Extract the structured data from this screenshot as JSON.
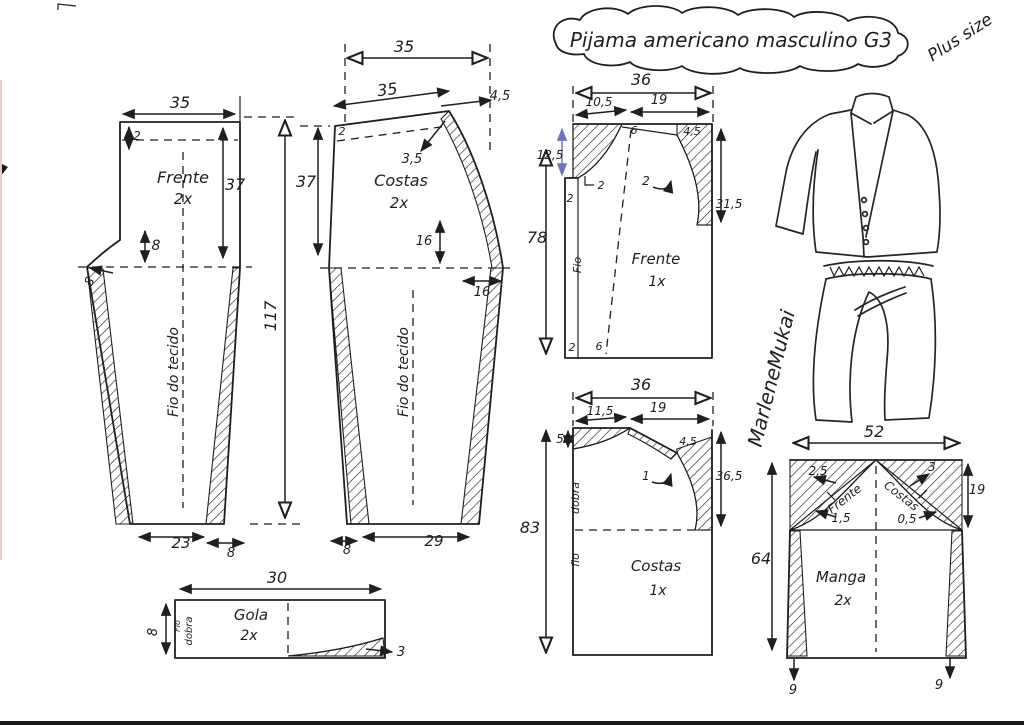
{
  "title": "Pijama americano masculino G3",
  "size_tag": "Plus size",
  "signature": "MarleneMukai",
  "colors": {
    "ink": "#1f1f1f",
    "blue": "#6f74b8",
    "lightblue": "#959bc2",
    "paper": "#ffffff"
  },
  "pieces": [
    {
      "name": "pants-front",
      "label": "Frente",
      "quantity": "2x",
      "grain_label": "Fio do tecido",
      "measurements": [
        "35",
        "2",
        "37",
        "8",
        "8",
        "117",
        "23",
        "8"
      ]
    },
    {
      "name": "pants-back",
      "label": "Costas",
      "quantity": "2x",
      "grain_label": "Fio do tecido",
      "measurements": [
        "35",
        "35",
        "4,5",
        "2",
        "37",
        "3,5",
        "16",
        "16",
        "8",
        "29"
      ]
    },
    {
      "name": "collar",
      "label": "Gola",
      "quantity": "2x",
      "grain_label": "Fio",
      "fold_label": "dobra",
      "measurements": [
        "30",
        "8",
        "3"
      ]
    },
    {
      "name": "shirt-front",
      "label": "Frente",
      "quantity": "1x",
      "grain_label": "Fio",
      "measurements": [
        "36",
        "10,5",
        "19",
        "12,5",
        "2",
        "2",
        "6",
        "4,5",
        "2",
        "31,5",
        "78",
        "2",
        "6"
      ]
    },
    {
      "name": "shirt-back",
      "label": "Costas",
      "quantity": "1x",
      "grain_label": "fio",
      "fold_label": "dobra",
      "measurements": [
        "36",
        "11,5",
        "19",
        "5",
        "4,5",
        "1",
        "36,5",
        "83"
      ]
    },
    {
      "name": "sleeve",
      "label": "Manga",
      "quantity": "2x",
      "curve_front_label": "Frente",
      "curve_back_label": "Costas",
      "measurements": [
        "52",
        "2,5",
        "3",
        "1,5",
        "0,5",
        "19",
        "64",
        "9",
        "9"
      ]
    }
  ],
  "labels": [
    {
      "name": "pants-front-width",
      "text": "35",
      "x": 180,
      "y": 108,
      "size": 16
    },
    {
      "name": "pants-front-casing",
      "text": "2",
      "x": 137,
      "y": 140,
      "size": 12
    },
    {
      "name": "pants-front-name",
      "text": "Frente",
      "x": 183,
      "y": 183,
      "size": 16
    },
    {
      "name": "pants-front-qty",
      "text": "2x",
      "x": 183,
      "y": 204,
      "size": 15
    },
    {
      "name": "pants-front-rise",
      "text": "37",
      "x": 235,
      "y": 190,
      "size": 16
    },
    {
      "name": "pants-front-hip-drop",
      "text": "8",
      "x": 156,
      "y": 250,
      "size": 14
    },
    {
      "name": "pants-front-crotch-ext",
      "text": "8",
      "x": 93,
      "y": 284,
      "size": 13,
      "rot": -55
    },
    {
      "name": "pants-front-grain",
      "text": "Fio do tecido",
      "x": 178,
      "y": 372,
      "size": 14,
      "rot": -90
    },
    {
      "name": "pants-length",
      "text": "117",
      "x": 276,
      "y": 316,
      "size": 16,
      "rot": -90
    },
    {
      "name": "pants-front-hem",
      "text": "23",
      "x": 181,
      "y": 548,
      "size": 15
    },
    {
      "name": "pants-front-hem-allow",
      "text": "8",
      "x": 231,
      "y": 557,
      "size": 13
    },
    {
      "name": "pants-back-width-top",
      "text": "35",
      "x": 404,
      "y": 52,
      "size": 16
    },
    {
      "name": "pants-back-width-slant",
      "text": "35",
      "x": 388,
      "y": 95,
      "size": 16,
      "rot": -7
    },
    {
      "name": "pants-back-rise-raise",
      "text": "4,5",
      "x": 500,
      "y": 100,
      "size": 13,
      "color": "blue"
    },
    {
      "name": "pants-back-casing",
      "text": "2",
      "x": 342,
      "y": 135,
      "size": 11
    },
    {
      "name": "pants-back-rise",
      "text": "37",
      "x": 306,
      "y": 187,
      "size": 16
    },
    {
      "name": "pants-back-corner",
      "text": "3,5",
      "x": 412,
      "y": 163,
      "size": 13
    },
    {
      "name": "pants-back-name",
      "text": "Costas",
      "x": 401,
      "y": 186,
      "size": 16
    },
    {
      "name": "pants-back-qty",
      "text": "2x",
      "x": 399,
      "y": 208,
      "size": 15
    },
    {
      "name": "pants-back-curve-height",
      "text": "16",
      "x": 424,
      "y": 245,
      "size": 13
    },
    {
      "name": "pants-back-crotch-ext",
      "text": "16",
      "x": 482,
      "y": 296,
      "size": 13
    },
    {
      "name": "pants-back-grain",
      "text": "Fio do tecido",
      "x": 408,
      "y": 372,
      "size": 14,
      "rot": -90
    },
    {
      "name": "pants-back-hem-allow",
      "text": "8",
      "x": 347,
      "y": 554,
      "size": 13
    },
    {
      "name": "pants-back-hem",
      "text": "29",
      "x": 434,
      "y": 546,
      "size": 15
    },
    {
      "name": "collar-width",
      "text": "30",
      "x": 277,
      "y": 583,
      "size": 16
    },
    {
      "name": "collar-height",
      "text": "8",
      "x": 157,
      "y": 632,
      "size": 13,
      "rot": -90
    },
    {
      "name": "collar-grain",
      "text": "Fio",
      "x": 180,
      "y": 626,
      "size": 8,
      "rot": -90
    },
    {
      "name": "collar-fold",
      "text": "dobra",
      "x": 192,
      "y": 631,
      "size": 10,
      "rot": -90
    },
    {
      "name": "collar-name",
      "text": "Gola",
      "x": 251,
      "y": 620,
      "size": 15
    },
    {
      "name": "collar-qty",
      "text": "2x",
      "x": 249,
      "y": 640,
      "size": 14
    },
    {
      "name": "collar-point",
      "text": "3",
      "x": 401,
      "y": 656,
      "size": 13
    },
    {
      "name": "shirt-front-width",
      "text": "36",
      "x": 641,
      "y": 85,
      "size": 16
    },
    {
      "name": "shirt-front-neck-width",
      "text": "10,5",
      "x": 599,
      "y": 106,
      "size": 12
    },
    {
      "name": "shirt-front-shoulder",
      "text": "19",
      "x": 659,
      "y": 104,
      "size": 13
    },
    {
      "name": "shirt-front-neck-depth",
      "text": "12,5",
      "x": 550,
      "y": 159,
      "size": 12,
      "color": "blue"
    },
    {
      "name": "shirt-front-placket",
      "text": "2",
      "x": 570,
      "y": 202,
      "size": 11
    },
    {
      "name": "shirt-front-notch",
      "text": "2",
      "x": 601,
      "y": 189,
      "size": 11
    },
    {
      "name": "shirt-front-shoulder-drop",
      "text": "6",
      "x": 634,
      "y": 134,
      "size": 11
    },
    {
      "name": "shirt-front-armhole-drop",
      "text": "4,5",
      "x": 692,
      "y": 135,
      "size": 11
    },
    {
      "name": "shirt-front-armhole-curve",
      "text": "2",
      "x": 646,
      "y": 185,
      "size": 12
    },
    {
      "name": "shirt-front-armhole-depth",
      "text": "31,5",
      "x": 729,
      "y": 208,
      "size": 12
    },
    {
      "name": "shirt-front-length",
      "text": "78",
      "x": 537,
      "y": 243,
      "size": 16
    },
    {
      "name": "shirt-front-grain",
      "text": "Fio",
      "x": 581,
      "y": 265,
      "size": 11,
      "rot": -90
    },
    {
      "name": "shirt-front-name",
      "text": "Frente",
      "x": 656,
      "y": 264,
      "size": 15
    },
    {
      "name": "shirt-front-qty",
      "text": "1x",
      "x": 657,
      "y": 286,
      "size": 14
    },
    {
      "name": "shirt-front-hem-placket",
      "text": "2",
      "x": 572,
      "y": 351,
      "size": 11
    },
    {
      "name": "shirt-front-hem-facing",
      "text": "6",
      "x": 599,
      "y": 350,
      "size": 11
    },
    {
      "name": "shirt-back-width",
      "text": "36",
      "x": 641,
      "y": 390,
      "size": 16
    },
    {
      "name": "shirt-back-neck-width",
      "text": "11,5",
      "x": 600,
      "y": 415,
      "size": 12
    },
    {
      "name": "shirt-back-shoulder",
      "text": "19",
      "x": 658,
      "y": 412,
      "size": 13
    },
    {
      "name": "shirt-back-neck-drop",
      "text": "5",
      "x": 560,
      "y": 443,
      "size": 12
    },
    {
      "name": "shirt-back-armhole-drop",
      "text": "4,5",
      "x": 688,
      "y": 445,
      "size": 11
    },
    {
      "name": "shirt-back-armhole-curve",
      "text": "1",
      "x": 646,
      "y": 480,
      "size": 12
    },
    {
      "name": "shirt-back-armhole-depth",
      "text": "36,5",
      "x": 729,
      "y": 480,
      "size": 12
    },
    {
      "name": "shirt-back-length",
      "text": "83",
      "x": 530,
      "y": 533,
      "size": 16
    },
    {
      "name": "shirt-back-fold",
      "text": "dobra",
      "x": 579,
      "y": 498,
      "size": 11,
      "rot": -90
    },
    {
      "name": "shirt-back-grain",
      "text": "fio",
      "x": 579,
      "y": 560,
      "size": 11,
      "rot": -90
    },
    {
      "name": "shirt-back-name",
      "text": "Costas",
      "x": 656,
      "y": 571,
      "size": 15
    },
    {
      "name": "shirt-back-qty",
      "text": "1x",
      "x": 658,
      "y": 595,
      "size": 14
    },
    {
      "name": "sleeve-width",
      "text": "52",
      "x": 874,
      "y": 437,
      "size": 16
    },
    {
      "name": "sleeve-cap-front-raise",
      "text": "2,5",
      "x": 818,
      "y": 475,
      "size": 12
    },
    {
      "name": "sleeve-cap-back-raise",
      "text": "3",
      "x": 932,
      "y": 471,
      "size": 12
    },
    {
      "name": "sleeve-curve-front",
      "text": "Frente",
      "x": 847,
      "y": 502,
      "size": 12,
      "rot": -38
    },
    {
      "name": "sleeve-curve-back",
      "text": "Costas",
      "x": 899,
      "y": 499,
      "size": 12,
      "rot": 38
    },
    {
      "name": "sleeve-cap-front-dip",
      "text": "1,5",
      "x": 841,
      "y": 522,
      "size": 12
    },
    {
      "name": "sleeve-cap-back-dip",
      "text": "0,5",
      "x": 907,
      "y": 523,
      "size": 12
    },
    {
      "name": "sleeve-cap-height",
      "text": "19",
      "x": 977,
      "y": 494,
      "size": 13,
      "color": "lightblue"
    },
    {
      "name": "sleeve-length",
      "text": "64",
      "x": 761,
      "y": 564,
      "size": 16
    },
    {
      "name": "sleeve-name",
      "text": "Manga",
      "x": 841,
      "y": 582,
      "size": 15
    },
    {
      "name": "sleeve-qty",
      "text": "2x",
      "x": 843,
      "y": 605,
      "size": 14
    },
    {
      "name": "sleeve-hem-left",
      "text": "9",
      "x": 793,
      "y": 694,
      "size": 13
    },
    {
      "name": "sleeve-hem-right",
      "text": "9",
      "x": 939,
      "y": 689,
      "size": 13
    }
  ]
}
